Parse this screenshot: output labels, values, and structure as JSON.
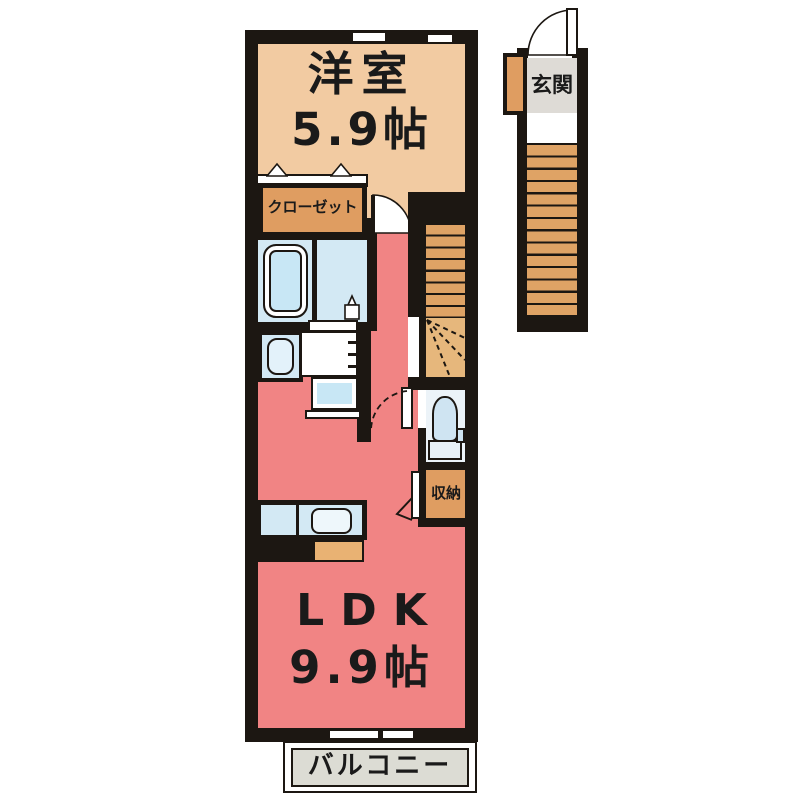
{
  "title": "apartment-floor-plan",
  "rooms": {
    "western_room": {
      "label": "洋室",
      "area": "5.9帖"
    },
    "closet": {
      "label": "クローゼット"
    },
    "ldk": {
      "label": "LDK",
      "area": "9.9帖"
    },
    "balcony": {
      "label": "バルコニー"
    },
    "entrance": {
      "label": "玄関"
    },
    "storage": {
      "label": "収納"
    }
  },
  "fixtures": [
    "bathtub",
    "washroom-faucet",
    "washbasin",
    "vanity-counter",
    "washing-machine-pan",
    "toilet",
    "kitchen-sink",
    "interior-stairs",
    "entrance-stairs",
    "winder-steps"
  ],
  "colors": {
    "wall": "#1c1712",
    "tan": "#f2cba2",
    "closet": "#df9d61",
    "salmon": "#f18484",
    "blue": "#d3e9f4",
    "tub": "#c8e7f5",
    "stairs": "#dfa365",
    "winder": "#e6b77c",
    "kitchen-orange": "#e9b273",
    "toilet-floor": "#ecf3f8",
    "sink-white": "#eef7fb",
    "balcony-gray": "#dcdcd4",
    "entrance-gray": "#dedbd6"
  }
}
